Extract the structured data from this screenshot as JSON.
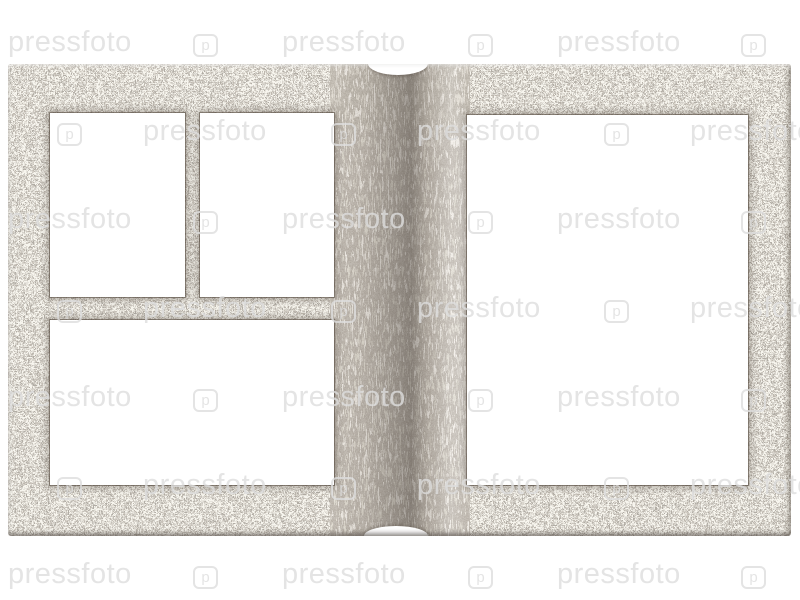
{
  "watermark": {
    "text": "pressfoto",
    "logo_glyph": "p"
  },
  "colors": {
    "background": "#ffffff",
    "granite_base": "#a69d92",
    "granite_light": "#d9d5cc",
    "granite_dark": "#575049",
    "window_fill": "#ffffff",
    "watermark": "rgba(221,221,221,0.80)"
  }
}
